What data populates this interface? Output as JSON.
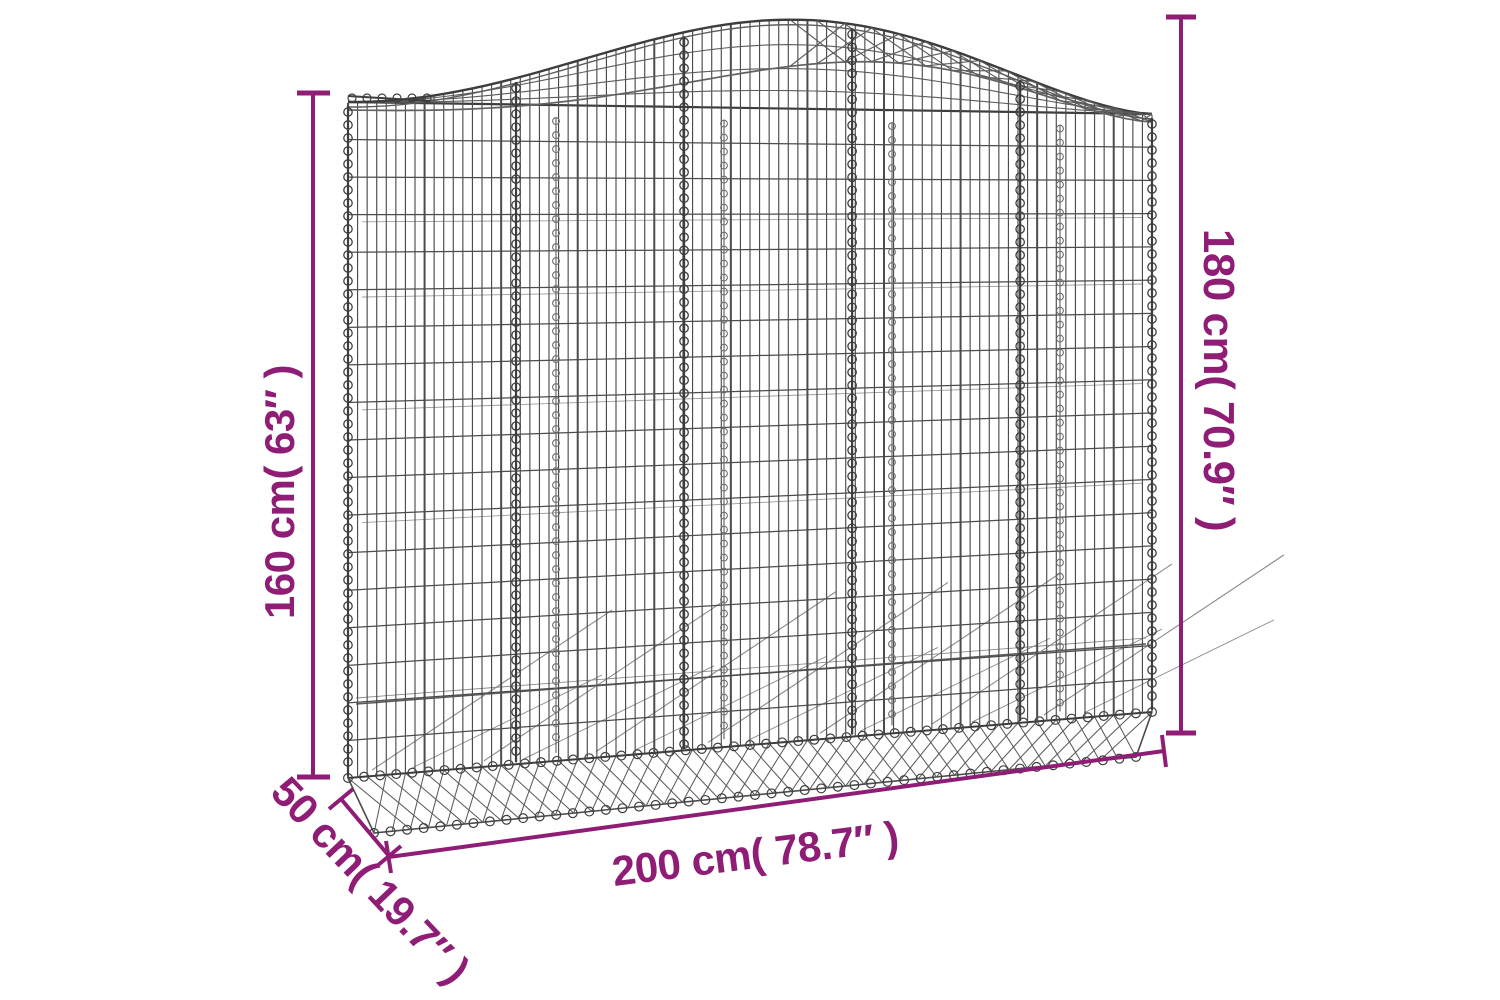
{
  "page": {
    "background": "#ffffff"
  },
  "diagram": {
    "annotation_color": "#8f1d76",
    "wire_color": "#3d3d3d",
    "dimensions": {
      "height_left": {
        "label": "160 cm( 63″ )"
      },
      "height_right": {
        "label": "180 cm( 70.9″ )"
      },
      "width": {
        "label": "200 cm( 78.7″ )"
      },
      "depth": {
        "label": "50 cm( 19.7″ )"
      }
    }
  }
}
